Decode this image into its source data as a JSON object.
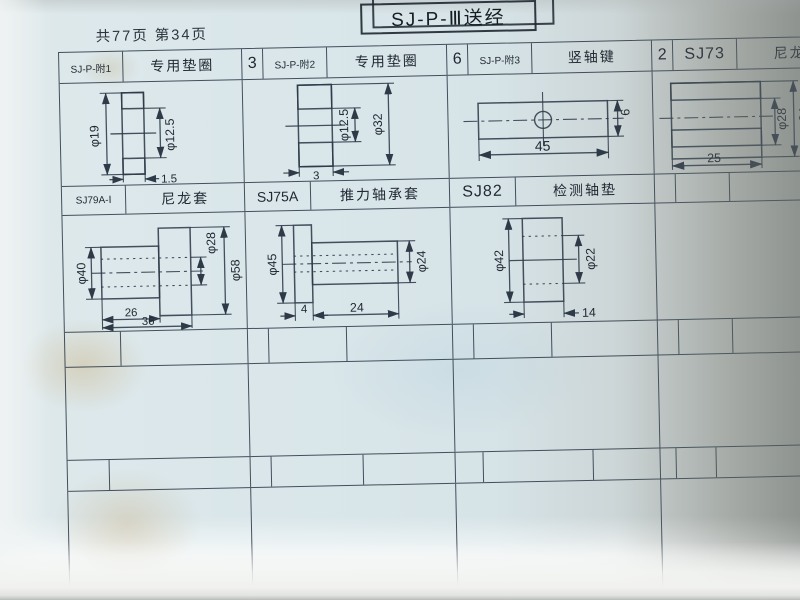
{
  "page": {
    "title": "SJ-P-Ⅲ送经",
    "page_info": "共77页 第34页"
  },
  "parts": {
    "p1": {
      "code": "SJ-P-附1",
      "name": "专用垫圈",
      "dims": {
        "outer": "φ19",
        "inner": "φ12.5",
        "thickness": "1.5"
      }
    },
    "p2": {
      "qty": "3",
      "code": "SJ-P-附2",
      "name": "专用垫圈",
      "dims": {
        "inner": "φ12.5",
        "outer": "φ32",
        "thickness": "3"
      }
    },
    "p3": {
      "qty": "6",
      "code": "SJ-P-附3",
      "name": "竖轴键",
      "dims": {
        "length": "45",
        "height": "6"
      }
    },
    "p4": {
      "qty": "2",
      "code": "SJ73",
      "name": "尼龙套",
      "dims": {
        "bore": "φ28",
        "outer": "φ34",
        "length": "25"
      }
    },
    "p5": {
      "code": "SJ79A-Ⅰ",
      "name": "尼龙套",
      "dims": {
        "body": "φ40",
        "bore": "φ28",
        "flange": "φ58",
        "body_length": "26",
        "total_length": "36"
      }
    },
    "p6": {
      "code": "SJ75A",
      "name": "推力轴承套",
      "dims": {
        "flange": "φ45",
        "flange_width": "4",
        "body_length": "24",
        "body": "φ24"
      }
    },
    "p7": {
      "code": "SJ82",
      "name": "检测轴垫",
      "dims": {
        "outer": "φ42",
        "bore": "φ22",
        "length": "14"
      }
    }
  }
}
